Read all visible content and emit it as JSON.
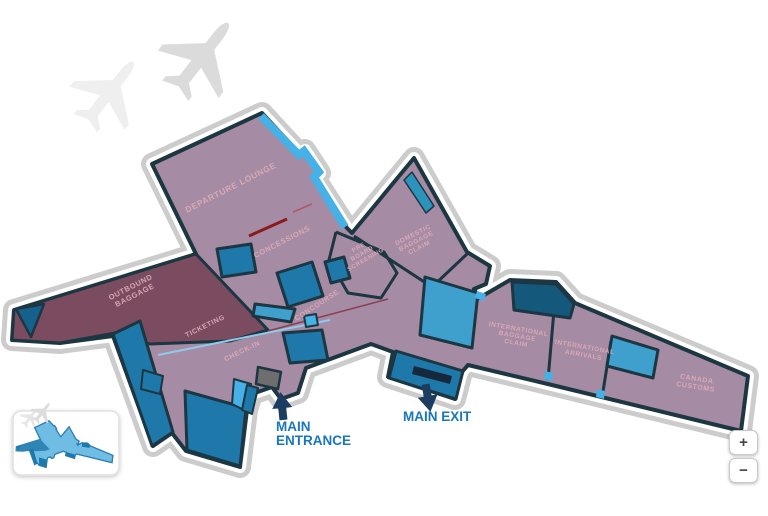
{
  "title": "Airport terminal floor map",
  "areas": {
    "departure_lounge": {
      "label": "DEPARTURE LOUNGE"
    },
    "concessions": {
      "label": "CONCESSIONS"
    },
    "outbound_baggage": {
      "line1": "OUTBOUND",
      "line2": "BAGGAGE"
    },
    "ticketing": {
      "label": "TICKETING"
    },
    "check_in": {
      "label": "CHECK-IN"
    },
    "concourse": {
      "label": "CONCOURSE"
    },
    "pre_board": {
      "line1": "PRE",
      "line2": "BOARD",
      "line3": "SCREENING"
    },
    "domestic_baggage": {
      "line1": "DOMESTIC",
      "line2": "BAGGAGE",
      "line3": "CLAIM"
    },
    "international_baggage": {
      "line1": "INTERNATIONAL",
      "line2": "BAGGAGE",
      "line3": "CLAIM"
    },
    "international_arrivals": {
      "line1": "INTERNATIONAL",
      "line2": "ARRIVALS"
    },
    "canada_customs": {
      "line1": "CANADA",
      "line2": "CUSTOMS"
    }
  },
  "markers": {
    "main_entrance": {
      "line1": "MAIN",
      "line2": "ENTRANCE"
    },
    "main_exit": {
      "label": "MAIN EXIT"
    }
  },
  "controls": {
    "zoom_in": "+",
    "zoom_out": "−"
  },
  "colors": {
    "mauve_area": "#A58BA3",
    "plum_area": "#7B4C60",
    "room_blue": "#1F78AA",
    "room_dark_blue": "#14587C",
    "room_light_blue": "#3FA0CE",
    "sky_blue": "#45B1E6",
    "outline_navy": "#1C3642",
    "band_gray": "#CCCCCC",
    "label_pink": "#DCAAB8",
    "marker_blue": "#1977BD",
    "arrow_navy": "#1C3D5F",
    "red_line": "#8B1A1A"
  }
}
